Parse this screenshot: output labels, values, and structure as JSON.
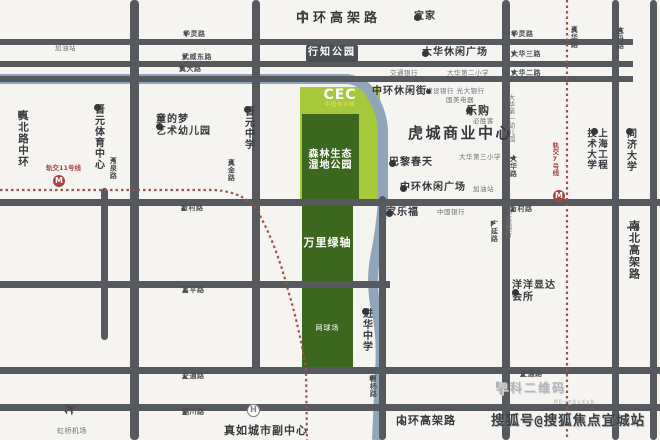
{
  "colors": {
    "background": "#f5f4f1",
    "road": "#56595d",
    "green_light": "#a6c93c",
    "green_dark": "#3c671e",
    "river": "#8fa6ba",
    "metro_red": "#a8423e",
    "badge_bg": "#4b4f53",
    "watermark_gray": "#b2b5b8",
    "watermark_dark": "#3d4043"
  },
  "green_zone": {
    "logo": "CEC",
    "logo_sub": "中国电子城",
    "park_line1": "森林生态",
    "park_line2": "湿地公园",
    "axis": "万里绿轴",
    "tennis": "网球场"
  },
  "metro": {
    "line11": "轨交11号线",
    "line7": "轨交7号线",
    "metro_icon": "M"
  },
  "watermark": {
    "line1": "早科二维码",
    "line2": "ME—@8vXvK",
    "line3": "搜狐号@搜狐焦点宜城站"
  },
  "labels": [
    {
      "id": "zhonghuan-elevated-label",
      "text": "中环高架路",
      "arrow": "↑"
    },
    {
      "id": "ikea-poi",
      "text": "宜家",
      "dot": true
    },
    {
      "id": "hualing-road-label-left",
      "text": "华灵路",
      "arrow": "▼"
    },
    {
      "id": "hualing-road-label-right",
      "text": "华灵路",
      "arrow": "▼"
    },
    {
      "id": "gas-station-top",
      "text": "加油站"
    },
    {
      "id": "wuwei-east-road-label",
      "text": "武威东路",
      "arrow": "▼"
    },
    {
      "id": "dahua-3rd-road-label",
      "text": "大华三路",
      "arrow": "▼"
    },
    {
      "id": "dahua-leisure-plaza-poi",
      "text": "大华休闲广场",
      "dot": true
    },
    {
      "id": "xingzhi-park-badge",
      "text": "行知公园"
    },
    {
      "id": "zhenda-road-label",
      "text": "真大路",
      "arrow": "▼"
    },
    {
      "id": "dahua-2nd-road-label",
      "text": "大华二路",
      "arrow": "▼"
    },
    {
      "id": "bocom-poi",
      "text": "交通银行"
    },
    {
      "id": "dahua-primary-school-2",
      "text": "大华第二小学"
    },
    {
      "id": "zhonghuan-leisure-street-poi",
      "text": "中环休闲街"
    },
    {
      "id": "ccb-everbright-poi",
      "text": "建设银行 光大银行",
      "dot": true
    },
    {
      "id": "gome-poi",
      "text": "国美电器"
    },
    {
      "id": "tesco-poi",
      "text": "乐购",
      "dot": true
    },
    {
      "id": "pizza-hut-poi",
      "text": "必胜客"
    },
    {
      "id": "hucheng-business-center",
      "text": "虎城商业中心"
    },
    {
      "id": "dahua-primary-school-3",
      "text": "大华第三小学"
    },
    {
      "id": "printemps-poi",
      "text": "巴黎春天",
      "dot": true
    },
    {
      "id": "zhonghuan-leisure-plaza-poi",
      "text": "中环休闲广场",
      "dot": true
    },
    {
      "id": "gas-station-mid",
      "text": "加油站"
    },
    {
      "id": "tongdemeng-kindergarten",
      "text": "童的梦",
      "text2": "艺术幼儿园",
      "dot": true
    },
    {
      "id": "jinyuan-middle-school",
      "text": "晋元中学",
      "dot": true
    },
    {
      "id": "jinyuan-sports-center",
      "text": "晋元体育中心",
      "dot": true
    },
    {
      "id": "wanquan-road-label",
      "text": "万泉路",
      "arrow": "◀"
    },
    {
      "id": "zhenjin-road-label",
      "text": "真金路",
      "arrow": "◀"
    },
    {
      "id": "zhenbei-middle-ring-label",
      "text": "真北路中环",
      "arrow": "▶"
    },
    {
      "id": "metro-line-11-label",
      "text": "轨交11号线"
    },
    {
      "id": "xincun-road-label-left",
      "text": "新村路",
      "arrow": "▲"
    },
    {
      "id": "xincun-road-label-right",
      "text": "新村路",
      "arrow": "▲"
    },
    {
      "id": "carrefour-poi",
      "text": "家乐福",
      "dot": true
    },
    {
      "id": "boc-poi",
      "text": "中国银行"
    },
    {
      "id": "fuping-road-label",
      "text": "富平路",
      "arrow": "▲"
    },
    {
      "id": "jiaotong-road-label-left",
      "text": "交通路",
      "arrow": "▲"
    },
    {
      "id": "jiaotong-road-label-right",
      "text": "交通路",
      "arrow": "▲"
    },
    {
      "id": "tongchuan-road-label",
      "text": "铜川路",
      "arrow": "▲"
    },
    {
      "id": "jinhua-middle-school",
      "text": "进华中学",
      "dot": true
    },
    {
      "id": "yangyang-club-poi",
      "text": "洋洋显达",
      "text2": "会所",
      "dot": true
    },
    {
      "id": "guangyan-road-label",
      "text": "广延路",
      "arrow": "▶"
    },
    {
      "id": "ccb-vert-poi",
      "text": "建设银行",
      "arrow": "◎"
    },
    {
      "id": "dahua-road-label",
      "text": "大华路",
      "arrow": "◀"
    },
    {
      "id": "dahua-kindergarten-1",
      "text": "大华第一幼儿园"
    },
    {
      "id": "zhenhua-road-label",
      "text": "真华路",
      "arrow": "◀"
    },
    {
      "id": "zhidan-road-label",
      "text": "志丹路",
      "arrow": "◀"
    },
    {
      "id": "sues-university",
      "text": "上海工程技术大学",
      "dot": true
    },
    {
      "id": "tongji-university",
      "text": "同济大学",
      "dot": true
    },
    {
      "id": "nanbei-elevated-label",
      "text": "南北高架路",
      "arrow": "→"
    },
    {
      "id": "hongqiao-airport",
      "text": "虹桥机场"
    },
    {
      "id": "zhenru-subcenter",
      "text": "真如城市副中心"
    },
    {
      "id": "neihuan-elevated-label",
      "text": "内环高架路",
      "arrow": "↓"
    },
    {
      "id": "caoyang-road-label",
      "text": "曹杨路",
      "arrow": "▶"
    }
  ]
}
